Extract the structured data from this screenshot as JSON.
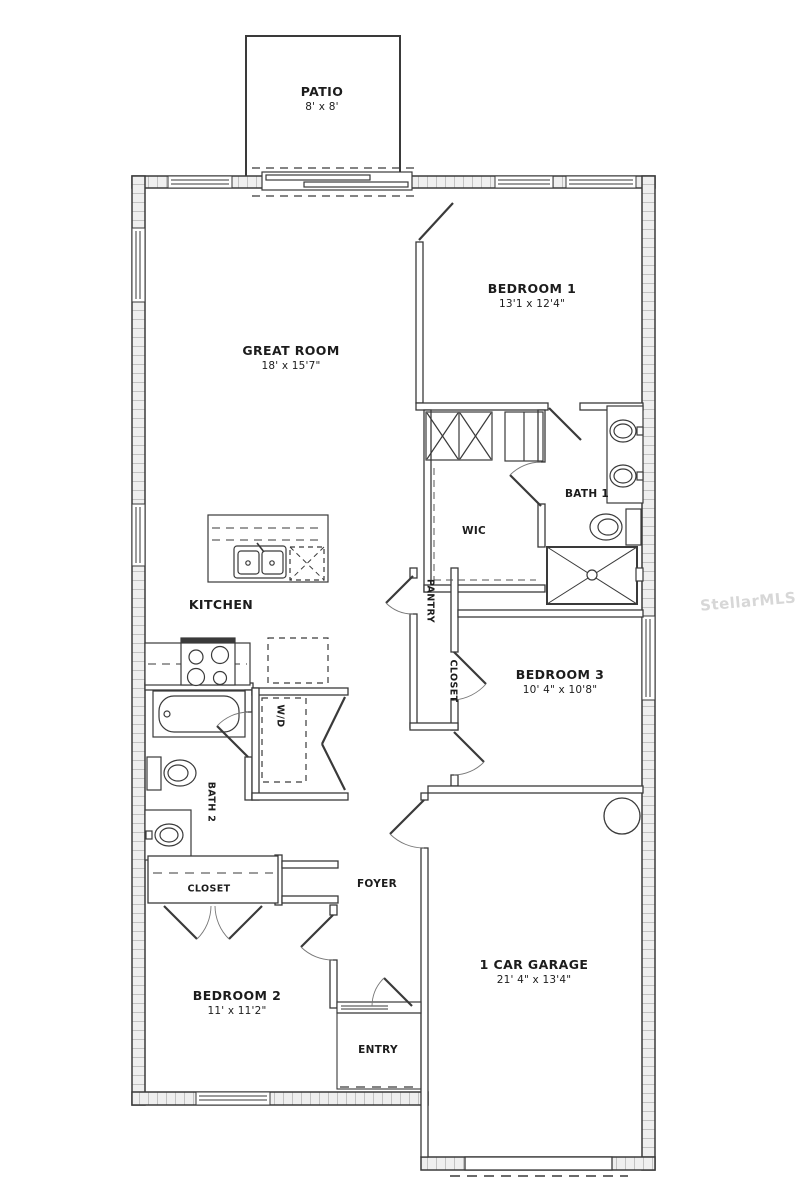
{
  "watermark": {
    "text": "StellarMLS"
  },
  "rooms": {
    "patio": {
      "name": "PATIO",
      "dims": "8' x 8'"
    },
    "great_room": {
      "name": "GREAT ROOM",
      "dims": "18' x 15'7\""
    },
    "bedroom1": {
      "name": "BEDROOM 1",
      "dims": "13'1 x 12'4\""
    },
    "bath1": {
      "name": "BATH 1"
    },
    "wic": {
      "name": "WIC"
    },
    "kitchen": {
      "name": "KITCHEN"
    },
    "pantry": {
      "name": "PANTRY"
    },
    "bedroom3_closet": {
      "name": "CLOSET"
    },
    "bedroom3": {
      "name": "BEDROOM 3",
      "dims": "10' 4\" x 10'8\""
    },
    "bath2": {
      "name": "BATH 2"
    },
    "laundry": {
      "name": "W/D"
    },
    "hall_closet": {
      "name": "CLOSET"
    },
    "foyer": {
      "name": "FOYER"
    },
    "bedroom2": {
      "name": "BEDROOM 2",
      "dims": "11' x 11'2\""
    },
    "entry": {
      "name": "ENTRY"
    },
    "garage": {
      "name": "1 CAR GARAGE",
      "dims": "21' 4\" x 13'4\""
    }
  },
  "colors": {
    "wall_line": "#3a3a3a",
    "wall_hatch": "#c2c2c2",
    "wall_fill": "#efefef",
    "label_text": "#1c1c1c",
    "watermark": "#d7d7d7"
  }
}
